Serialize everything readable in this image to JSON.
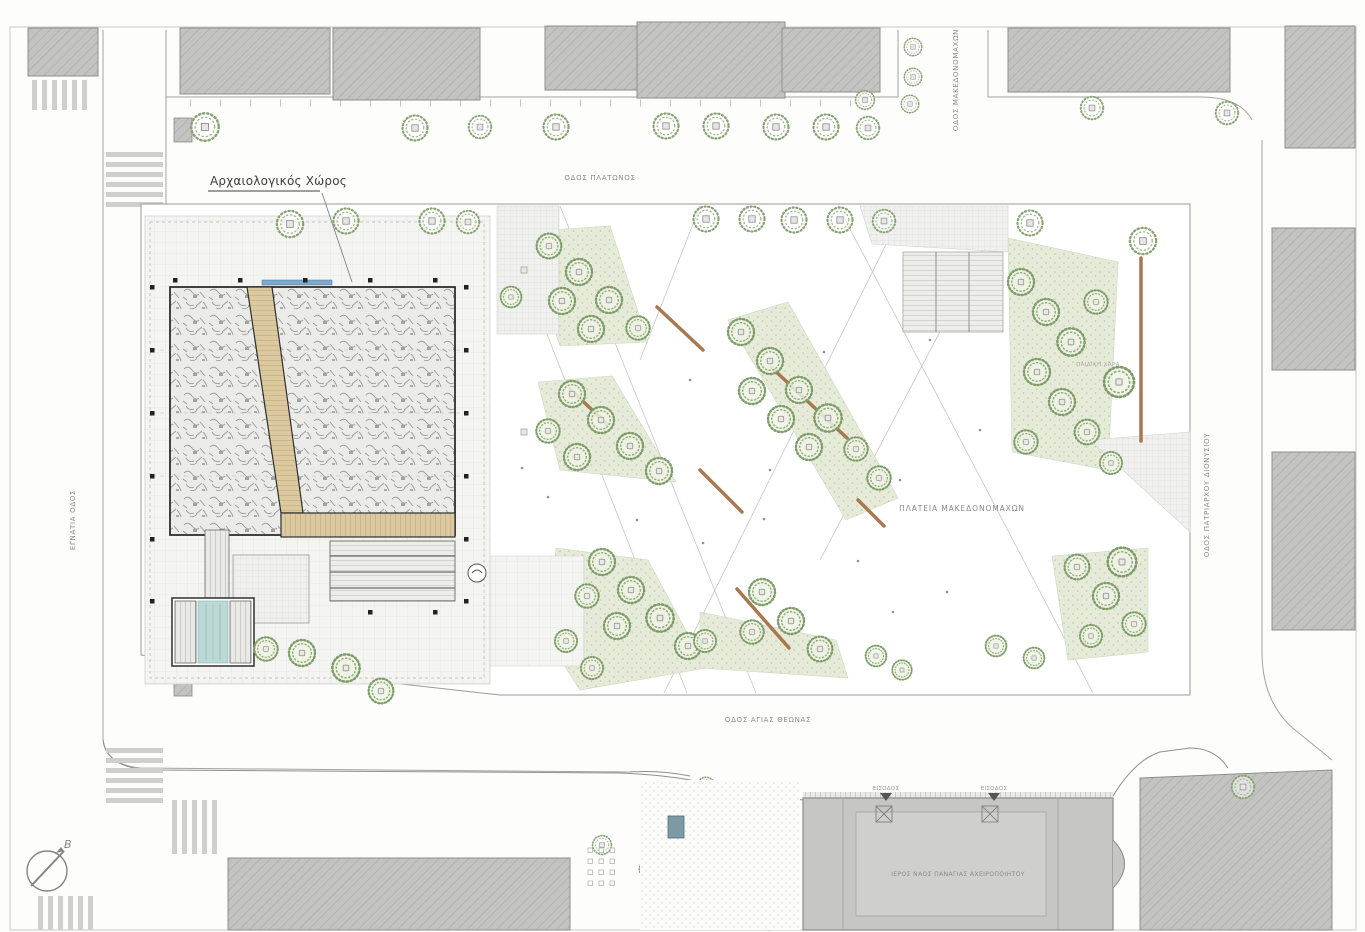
{
  "drawing": {
    "type": "architectural-site-plan",
    "site_label": "Αρχαιολογικός Χώρος",
    "plaza_label": "ΠΛΑΤΕΙΑ ΜΑΚΕΔΟΝΟΜΑΧΩΝ",
    "playground_label": "ΠΑΙΔΙΚΗ ΧΑΡΑ",
    "church_label": "ΙΕΡΟΣ ΝΑΟΣ ΠΑΝΑΓΙΑΣ ΑΧΕΙΡΟΠΟΙΗΤΟΥ",
    "entrance_label_1": "ΕΙΣΟΔΟΣ",
    "entrance_label_2": "ΕΙΣΟΔΟΣ",
    "streets": {
      "top": "ΟΔΟΣ ΠΛΑΤΩΝΟΣ",
      "bottom": "ΟΔΟΣ ΑΓΙΑΣ ΘΕΩΝΑΣ",
      "left": "ΕΓΝΑΤΙΑ ΟΔΟΣ",
      "right": "ΟΔΟΣ ΠΑΤΡΙΑΡΧΟΥ ΔΙΟΝΥΣΙΟΥ",
      "top_right": "ΟΔΟΣ ΜΑΚΕΔΟΝΟΜΑΧΩΝ"
    },
    "compass_north_label": "Β",
    "colors": {
      "wood_deck": "#d9c9a0",
      "water": "#bcd9d5",
      "tree_green": "#7f9e6e",
      "planting_bed": "#e6ebd9",
      "building_gray": "#c3c3c3",
      "excavation_gray": "#ebebe9",
      "line_gray": "#9a9a98",
      "bench_brown": "#a8784f",
      "accent_blue": "#7fa8c9"
    }
  }
}
